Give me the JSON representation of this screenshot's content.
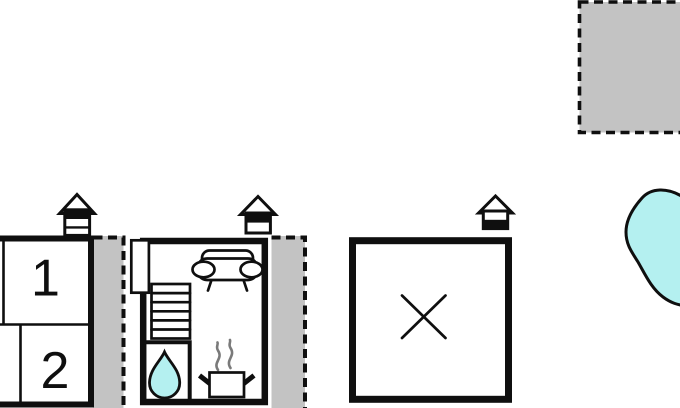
{
  "colors": {
    "wall": "#0f0f0f",
    "terrace": "#c3c3c3",
    "water": "#b4f0f0",
    "steam": "#7a7a7a",
    "paper": "#ffffff"
  },
  "floorplan": {
    "rooms": [
      {
        "id": "room-1",
        "label": "1"
      },
      {
        "id": "room-2",
        "label": "2"
      }
    ],
    "buildings": [
      {
        "name": "guest-house",
        "rooms": [
          "1",
          "2"
        ],
        "entrance": "entrance-house-icon"
      },
      {
        "name": "main-house",
        "entrance": "entrance-house-icon",
        "features": [
          "door-opening",
          "stairs",
          "sofa",
          "bathroom-water-drop",
          "cooking-pot-with-steam"
        ]
      },
      {
        "name": "outbuilding",
        "entrance": "entrance-house-icon",
        "features": [
          "crossed-square"
        ]
      }
    ],
    "outdoor_areas": [
      {
        "name": "annex-dashed-area",
        "style": "gray-dashed"
      },
      {
        "name": "terrace-left",
        "style": "gray-dashed"
      },
      {
        "name": "terrace-middle",
        "style": "gray-dashed"
      },
      {
        "name": "pool",
        "style": "water"
      }
    ]
  }
}
